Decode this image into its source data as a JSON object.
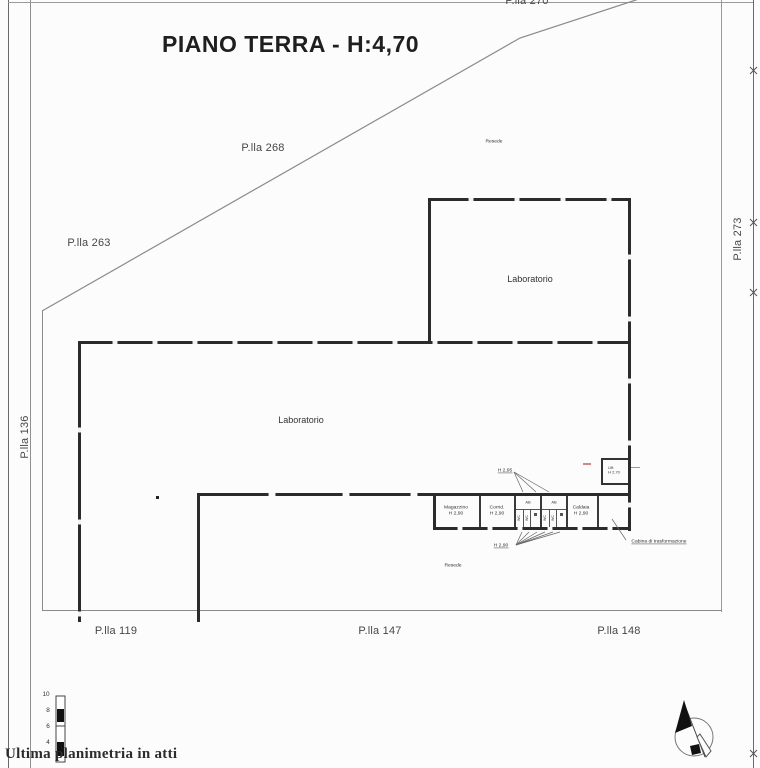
{
  "title": "PIANO TERRA - H:4,70",
  "footer": "Ultima planimetria in atti",
  "parcels": {
    "p270": "P.lla 270",
    "p268": "P.lla 268",
    "p263": "P.lla 263",
    "p273": "P.lla 273",
    "p136": "P.lla 136",
    "p119": "P.lla 119",
    "p147": "P.lla 147",
    "p148": "P.lla 148"
  },
  "areas": {
    "resede_top": "Resede",
    "resede_bottom": "Resede"
  },
  "rooms": {
    "laboratorio_upper": "Laboratorio",
    "laboratorio_main": "Laboratorio",
    "magazzino": {
      "name": "Magazzino",
      "height": "H 2,90"
    },
    "corridoio": {
      "name": "Corrid.",
      "height": "H 2,90"
    },
    "antibagno": "AB",
    "wc": "WC",
    "caldaia": {
      "name": "Caldaia",
      "height": "H 2,90"
    },
    "ufficio": {
      "name": "Uff.",
      "height": "H 2,70"
    }
  },
  "annotations": {
    "height_antibagno": "H 2,95",
    "height_wc": "H 2,90",
    "cabina": "Cabina di trasformazione"
  },
  "scale_bar": {
    "ticks": [
      "10",
      "8",
      "6",
      "4"
    ]
  },
  "colors": {
    "wall": "#2b2b2b",
    "boundary": "#8a8a8a",
    "text": "#3f3f3f",
    "red_mark": "#c06060"
  }
}
